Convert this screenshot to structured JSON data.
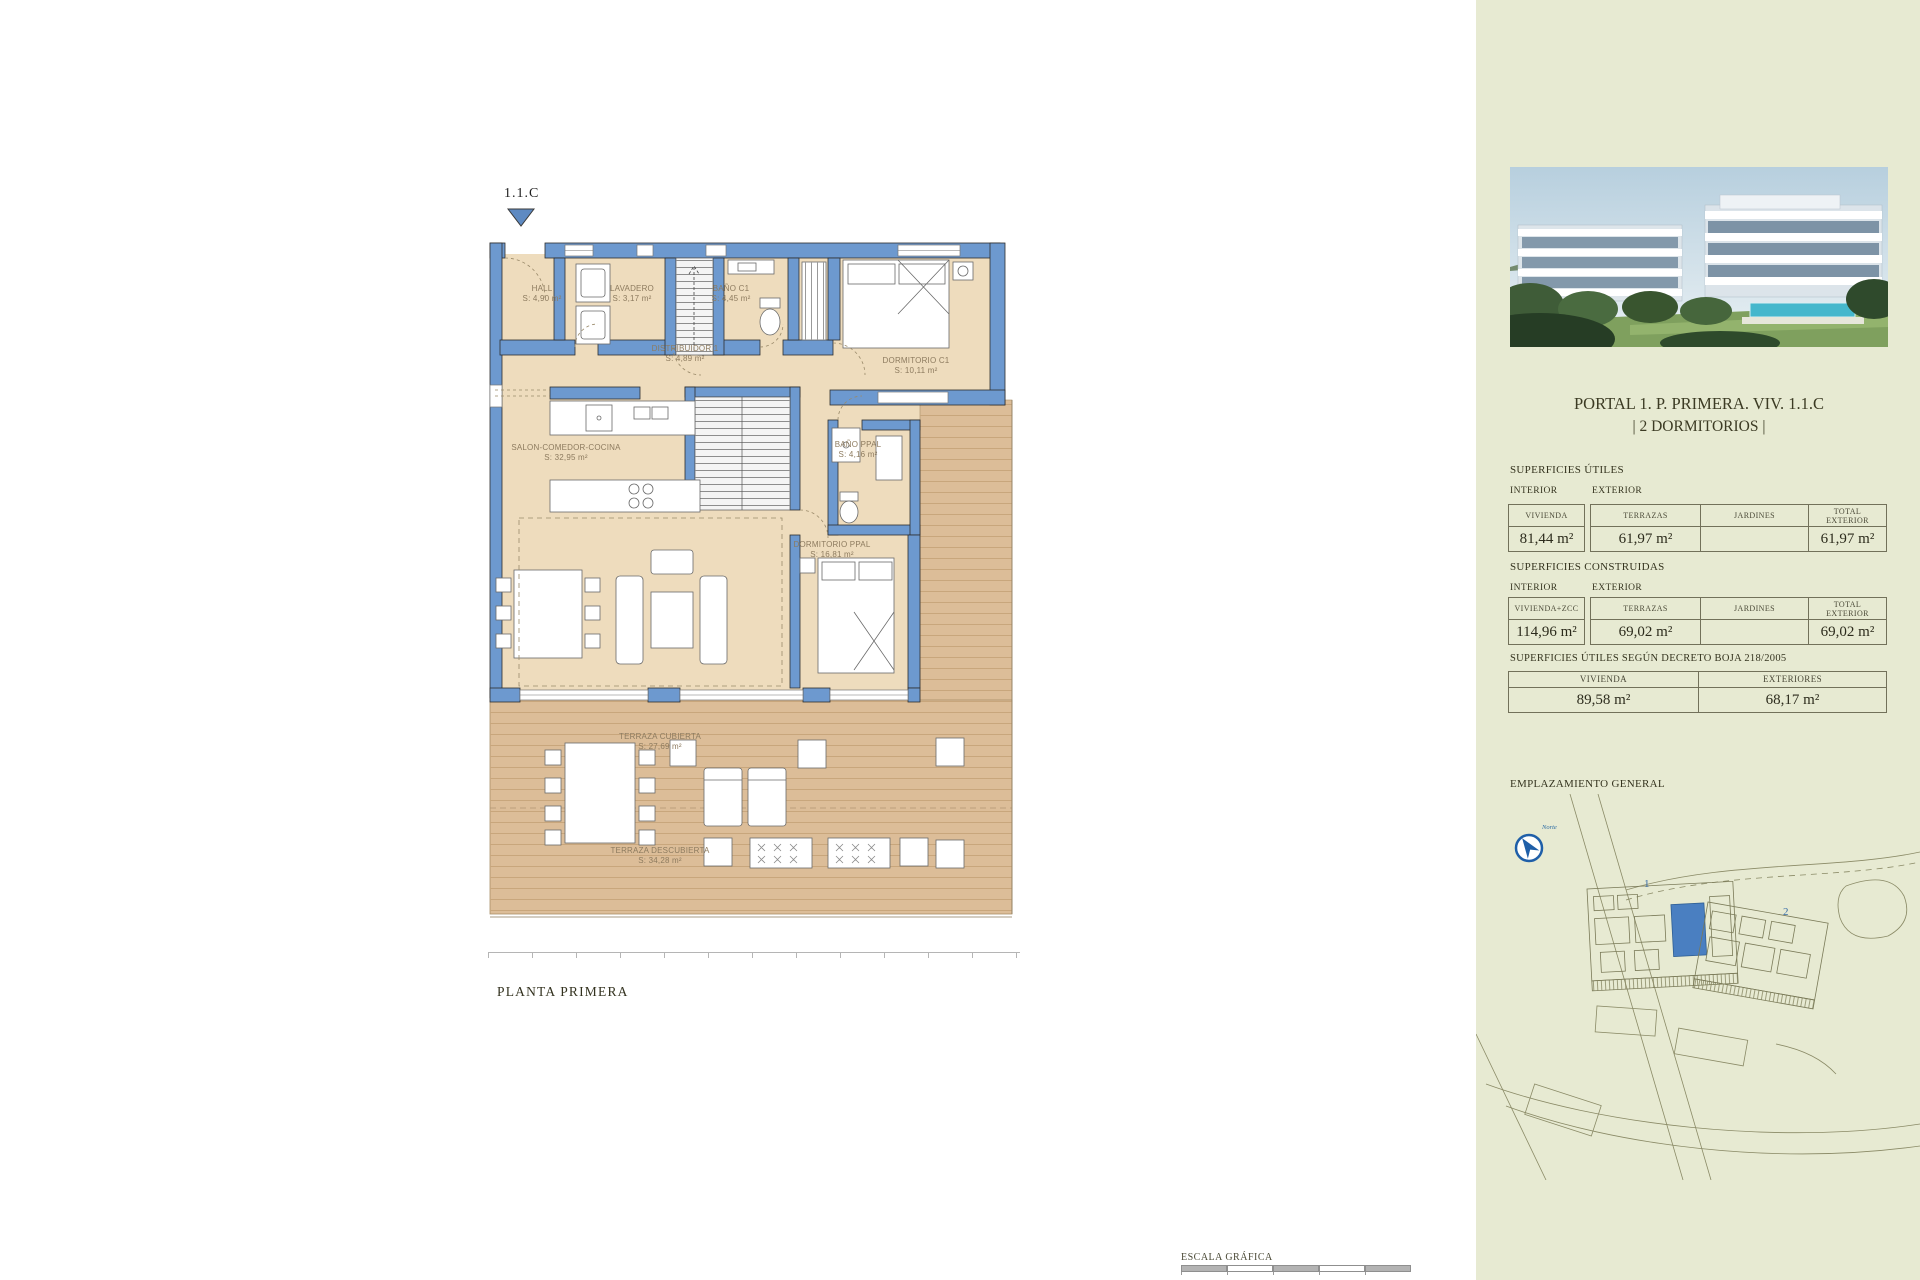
{
  "plan": {
    "marker": "1.1.C",
    "floor_label": "PLANTA PRIMERA",
    "scale_label": "ESCALA GRÁFICA",
    "rooms": {
      "hall": {
        "name": "HALL",
        "area": "S: 4,90 m²"
      },
      "lavadero": {
        "name": "LAVADERO",
        "area": "S: 3,17 m²"
      },
      "bano_c1": {
        "name": "BAÑO C1",
        "area": "S: 4,45 m²"
      },
      "distribuidor": {
        "name": "DISTRIBUIDOR 1",
        "area": "S: 4,89 m²"
      },
      "dormitorio_c1": {
        "name": "DORMITORIO C1",
        "area": "S: 10,11 m²"
      },
      "salon": {
        "name": "SALON-COMEDOR-COCINA",
        "area": "S: 32,95 m²"
      },
      "bano_ppal": {
        "name": "BAÑO PPAL",
        "area": "S: 4,16 m²"
      },
      "dormitorio_ppal": {
        "name": "DORMITORIO PPAL",
        "area": "S: 16,81 m²"
      },
      "terraza_cubierta": {
        "name": "TERRAZA CUBIERTA",
        "area": "S: 27,69 m²"
      },
      "terraza_descubierta": {
        "name": "TERRAZA DESCUBIERTA",
        "area": "S: 34,28 m²"
      }
    }
  },
  "sidebar": {
    "title_line1": "PORTAL 1. P. PRIMERA. VIV. 1.1.C",
    "title_line2": "| 2 DORMITORIOS |",
    "utiles": {
      "heading": "SUPERFICIES ÚTILES",
      "interior_label": "INTERIOR",
      "exterior_label": "EXTERIOR",
      "cols": {
        "vivienda": "VIVIENDA",
        "terrazas": "TERRAZAS",
        "jardines": "JARDINES",
        "total": "TOTAL EXTERIOR"
      },
      "values": {
        "vivienda": "81,44 m²",
        "terrazas": "61,97 m²",
        "jardines": "",
        "total": "61,97 m²"
      }
    },
    "construidas": {
      "heading": "SUPERFICIES CONSTRUIDAS",
      "interior_label": "INTERIOR",
      "exterior_label": "EXTERIOR",
      "cols": {
        "vivienda": "VIVIENDA+ZCC",
        "terrazas": "TERRAZAS",
        "jardines": "JARDINES",
        "total": "TOTAL EXTERIOR"
      },
      "values": {
        "vivienda": "114,96 m²",
        "terrazas": "69,02 m²",
        "jardines": "",
        "total": "69,02 m²"
      }
    },
    "decreto": {
      "heading": "SUPERFICIES ÚTILES SEGÚN DECRETO BOJA 218/2005",
      "cols": {
        "vivienda": "VIVIENDA",
        "exteriores": "EXTERIORES"
      },
      "values": {
        "vivienda": "89,58 m²",
        "exteriores": "68,17 m²"
      }
    },
    "emplazamiento": {
      "heading": "EMPLAZAMIENTO GENERAL",
      "compass_label": "Norte",
      "building1_label": "1",
      "building2_label": "2"
    }
  },
  "colors": {
    "wall_blue": "#6d99cf",
    "floor_tan": "#eedcbd",
    "terrace_wood": "#dcbd98",
    "sidebar_bg": "#e7ead2",
    "highlight_blue": "#4a7fc1",
    "marker_blue": "#5e8ac2"
  }
}
